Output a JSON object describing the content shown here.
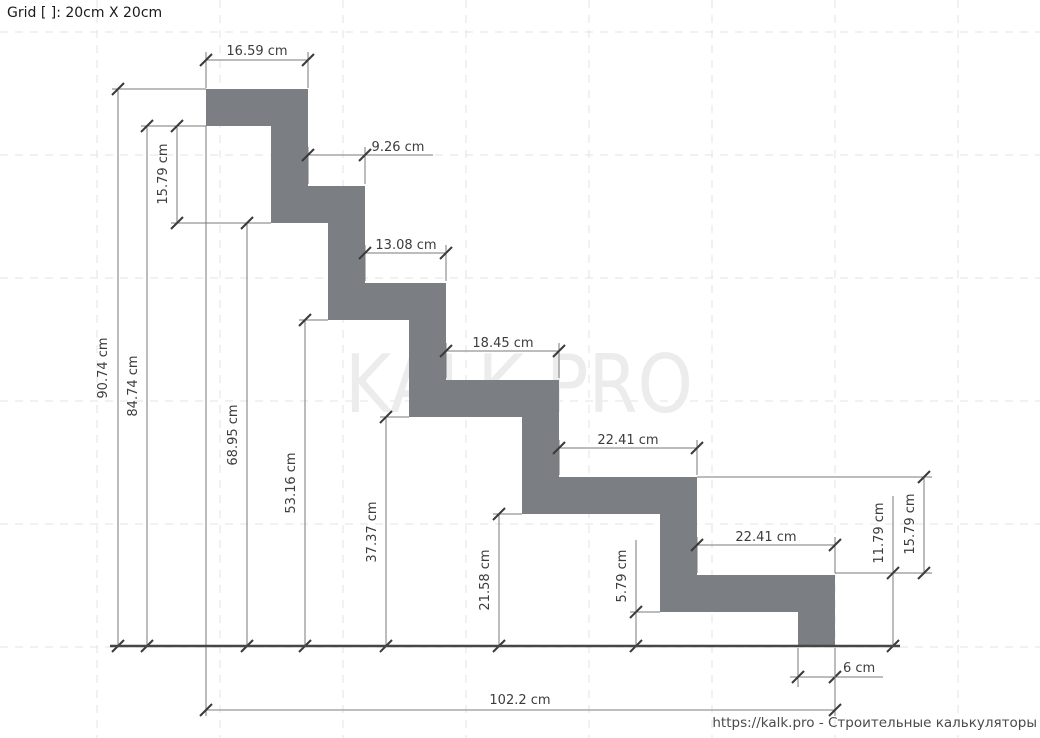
{
  "header": {
    "grid_label": "Grid [ ]: 20cm X 20cm"
  },
  "watermark": {
    "text": "KALK.PRO"
  },
  "footer": {
    "text": "https://kalk.pro - Строительные калькуляторы"
  },
  "colors": {
    "background": "#ffffff",
    "grid": "#e3e3e3",
    "profile_fill": "#7b7f83",
    "dim_line": "#7a7a7a",
    "dim_line_light": "#a8a8a8",
    "ext_line": "#7a7a7a",
    "tick": "#3a3a3a",
    "dim_text": "#3c3c3c",
    "baseline": "#464646",
    "watermark": "#ececec"
  },
  "drawing": {
    "canvas": {
      "width": 1040,
      "height": 738
    },
    "scale_px_per_cm": 6.154,
    "grid": {
      "cell_cm": 20,
      "vertical_x": [
        97,
        220,
        343,
        466,
        589,
        712,
        835,
        958
      ],
      "horizontal_y": [
        32,
        155,
        278,
        401,
        524,
        647
      ]
    },
    "profile_points": "206,89 308,89 308,186 365,186 365,283 446,283 446,380 559,380 559,477 697,477 697,575 835,575 835,646 798,646 798,612 660,612 660,514 522,514 522,417 409,417 409,320 328,320 328,223 271,223 271,126 206,126",
    "baseline": [
      110,
      646,
      900,
      646
    ],
    "dimensions": [
      {
        "name": "tread-1-width",
        "value": "16.59 cm",
        "value_cm": 16.59,
        "rotated": false,
        "light": false,
        "line": [
          206,
          60,
          308,
          60
        ],
        "ticks": [
          [
            206,
            60
          ],
          [
            308,
            60
          ]
        ],
        "ext": [
          [
            206,
            52,
            206,
            88
          ],
          [
            308,
            52,
            308,
            88
          ]
        ],
        "label_pos": [
          257,
          55
        ],
        "anchor": "middle"
      },
      {
        "name": "tread-2-width",
        "value": "9.26 cm",
        "value_cm": 9.26,
        "rotated": false,
        "light": false,
        "line": [
          308,
          155,
          433,
          155
        ],
        "ticks": [
          [
            308,
            155
          ],
          [
            365,
            155
          ]
        ],
        "ext": [
          [
            308,
            147,
            308,
            184
          ],
          [
            365,
            147,
            365,
            184
          ]
        ],
        "label_pos": [
          398,
          151
        ],
        "anchor": "middle"
      },
      {
        "name": "tread-3-width",
        "value": "13.08 cm",
        "value_cm": 13.08,
        "rotated": false,
        "light": false,
        "line": [
          365,
          253,
          446,
          253
        ],
        "ticks": [
          [
            365,
            253
          ],
          [
            446,
            253
          ]
        ],
        "ext": [
          [
            365,
            245,
            365,
            281
          ],
          [
            446,
            245,
            446,
            281
          ]
        ],
        "label_pos": [
          406,
          249
        ],
        "anchor": "middle"
      },
      {
        "name": "tread-4-width",
        "value": "18.45 cm",
        "value_cm": 18.45,
        "rotated": false,
        "light": false,
        "line": [
          446,
          351,
          559,
          351
        ],
        "ticks": [
          [
            446,
            351
          ],
          [
            559,
            351
          ]
        ],
        "ext": [
          [
            446,
            343,
            446,
            378
          ],
          [
            559,
            343,
            559,
            378
          ]
        ],
        "label_pos": [
          503,
          347
        ],
        "anchor": "middle"
      },
      {
        "name": "tread-5-width",
        "value": "22.41 cm",
        "value_cm": 22.41,
        "rotated": false,
        "light": false,
        "line": [
          559,
          448,
          697,
          448
        ],
        "ticks": [
          [
            559,
            448
          ],
          [
            697,
            448
          ]
        ],
        "ext": [
          [
            559,
            440,
            559,
            475
          ],
          [
            697,
            440,
            697,
            475
          ]
        ],
        "label_pos": [
          628,
          444
        ],
        "anchor": "middle"
      },
      {
        "name": "tread-6-width",
        "value": "22.41 cm",
        "value_cm": 22.41,
        "rotated": false,
        "light": false,
        "line": [
          697,
          545,
          835,
          545
        ],
        "ticks": [
          [
            697,
            545
          ],
          [
            835,
            545
          ]
        ],
        "ext": [
          [
            697,
            537,
            697,
            573
          ],
          [
            835,
            537,
            835,
            573
          ]
        ],
        "label_pos": [
          766,
          541
        ],
        "anchor": "middle"
      },
      {
        "name": "end-width",
        "value": "6 cm",
        "value_cm": 6,
        "rotated": false,
        "light": false,
        "line": [
          790,
          677,
          883,
          677
        ],
        "ticks": [
          [
            798,
            677
          ],
          [
            835,
            677
          ]
        ],
        "ext": [
          [
            798,
            648,
            798,
            687
          ]
        ],
        "label_pos": [
          843,
          672
        ],
        "anchor": "start"
      },
      {
        "name": "total-run",
        "value": "102.2 cm",
        "value_cm": 102.2,
        "rotated": false,
        "light": true,
        "line": [
          206,
          710,
          835,
          710
        ],
        "ticks": [
          [
            206,
            710
          ],
          [
            835,
            710
          ]
        ],
        "ext": [
          [
            206,
            126,
            206,
            716
          ],
          [
            835,
            648,
            835,
            716
          ]
        ],
        "label_pos": [
          520,
          704
        ],
        "anchor": "middle"
      },
      {
        "name": "total-height",
        "value": "90.74 cm",
        "value_cm": 90.74,
        "rotated": true,
        "light": false,
        "line": [
          118,
          89,
          118,
          646
        ],
        "ticks": [
          [
            118,
            89
          ],
          [
            118,
            646
          ]
        ],
        "ext": [
          [
            112,
            89,
            206,
            89
          ]
        ],
        "label_pos": [
          107,
          368
        ],
        "anchor": "middle"
      },
      {
        "name": "height-to-inner-top",
        "value": "84.74 cm",
        "value_cm": 84.74,
        "rotated": true,
        "light": false,
        "line": [
          147,
          126,
          147,
          646
        ],
        "ticks": [
          [
            147,
            126
          ],
          [
            147,
            646
          ]
        ],
        "ext": [
          [
            141,
            126,
            206,
            126
          ]
        ],
        "label_pos": [
          137,
          386
        ],
        "anchor": "middle"
      },
      {
        "name": "riser-left",
        "value": "15.79 cm",
        "value_cm": 15.79,
        "rotated": true,
        "light": false,
        "line": [
          177,
          126,
          177,
          223
        ],
        "ticks": [
          [
            177,
            126
          ],
          [
            177,
            223
          ]
        ],
        "ext": [
          [
            171,
            223,
            271,
            223
          ]
        ],
        "label_pos": [
          167,
          174
        ],
        "anchor": "middle"
      },
      {
        "name": "height-step-2",
        "value": "68.95 cm",
        "value_cm": 68.95,
        "rotated": true,
        "light": false,
        "line": [
          247,
          223,
          247,
          646
        ],
        "ticks": [
          [
            247,
            223
          ],
          [
            247,
            646
          ]
        ],
        "ext": [],
        "label_pos": [
          237,
          435
        ],
        "anchor": "middle"
      },
      {
        "name": "height-step-3",
        "value": "53.16 cm",
        "value_cm": 53.16,
        "rotated": true,
        "light": false,
        "line": [
          305,
          320,
          305,
          646
        ],
        "ticks": [
          [
            305,
            320
          ],
          [
            305,
            646
          ]
        ],
        "ext": [
          [
            299,
            320,
            328,
            320
          ]
        ],
        "label_pos": [
          295,
          483
        ],
        "anchor": "middle"
      },
      {
        "name": "height-step-4",
        "value": "37.37 cm",
        "value_cm": 37.37,
        "rotated": true,
        "light": false,
        "line": [
          386,
          417,
          386,
          646
        ],
        "ticks": [
          [
            386,
            417
          ],
          [
            386,
            646
          ]
        ],
        "ext": [
          [
            380,
            417,
            409,
            417
          ]
        ],
        "label_pos": [
          376,
          532
        ],
        "anchor": "middle"
      },
      {
        "name": "height-step-5",
        "value": "21.58 cm",
        "value_cm": 21.58,
        "rotated": true,
        "light": false,
        "line": [
          499,
          514,
          499,
          646
        ],
        "ticks": [
          [
            499,
            514
          ],
          [
            499,
            646
          ]
        ],
        "ext": [
          [
            493,
            514,
            522,
            514
          ]
        ],
        "label_pos": [
          489,
          580
        ],
        "anchor": "middle"
      },
      {
        "name": "height-step-6",
        "value": "5.79 cm",
        "value_cm": 5.79,
        "rotated": true,
        "light": false,
        "line": [
          636,
          540,
          636,
          646
        ],
        "ticks": [
          [
            636,
            612
          ],
          [
            636,
            646
          ]
        ],
        "ext": [
          [
            630,
            612,
            660,
            612
          ]
        ],
        "label_pos": [
          626,
          576
        ],
        "anchor": "middle"
      },
      {
        "name": "end-height",
        "value": "11.79 cm",
        "value_cm": 11.79,
        "rotated": true,
        "light": false,
        "line": [
          893,
          496,
          893,
          646
        ],
        "ticks": [
          [
            893,
            573
          ],
          [
            893,
            646
          ]
        ],
        "ext": [
          [
            835,
            573,
            932,
            573
          ],
          [
            893,
            646,
            900,
            646
          ]
        ],
        "label_pos": [
          883,
          533
        ],
        "anchor": "middle"
      },
      {
        "name": "riser-right",
        "value": "15.79 cm",
        "value_cm": 15.79,
        "rotated": true,
        "light": false,
        "line": [
          924,
          477,
          924,
          573
        ],
        "ticks": [
          [
            924,
            477
          ],
          [
            924,
            573
          ]
        ],
        "ext": [
          [
            697,
            477,
            932,
            477
          ]
        ],
        "label_pos": [
          914,
          524
        ],
        "anchor": "middle"
      }
    ]
  }
}
